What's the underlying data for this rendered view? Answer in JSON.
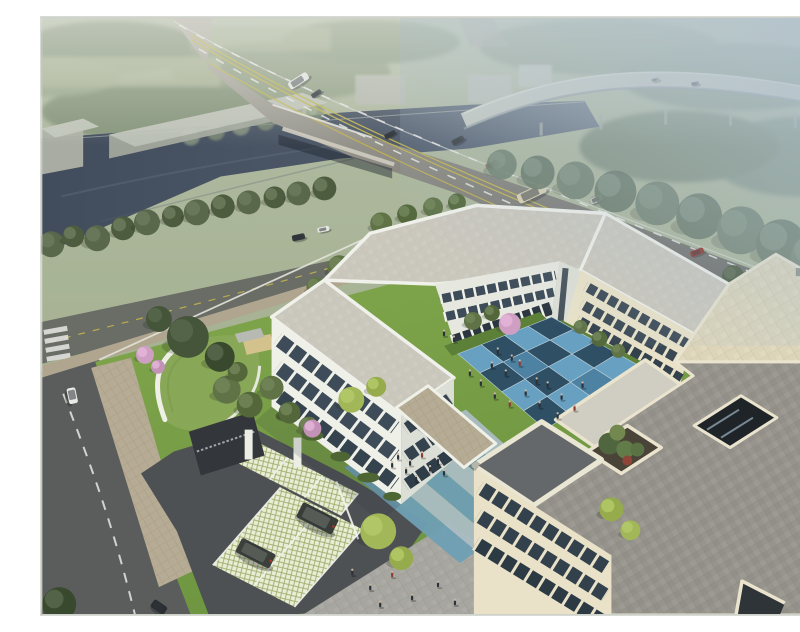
{
  "meta": {
    "alt": "Aerial architectural rendering of a three-story U-shaped cream campus building around a blue checkerboard courtyard, with entrance gate, green-roof gatehouse, grass-grid parking, landscaped gardens, an arterial road crossing a river bridge, and a hazy elevated highway ramp"
  },
  "palette": {
    "field": "#a4ae93",
    "field_light": "#aeb79a",
    "distant_tree": "#8c9a82",
    "water": "#485363",
    "water_light": "#647080",
    "warehouse_roof": "#c1c5bb",
    "warehouse_side": "#a3a89d",
    "ramp": "#c4c8c1",
    "road_far": "#b4b1a7",
    "road_near": "#5f5f5c",
    "lane_white": "#e8e8e4",
    "lane_yellow": "#c3b44e",
    "local_road": "#6a6c66",
    "access_road": "#5b5d5c",
    "sidewalk_tan": "#b6ab94",
    "lawn": "#79a147",
    "lawn_shade": "#5d8038",
    "hedge": "#4e6534",
    "bank_tree": "#59684a",
    "tree_dark": "#45553a",
    "tree_mid": "#5f7347",
    "tree_light": "#7d9254",
    "tree_yellow": "#a2b757",
    "tree_haze": "#5e7056",
    "blossom_pink": "#cf9fc3",
    "gatehouse_roof": "#88a757",
    "gatehouse_trim": "#edeee4",
    "driveway": "#4e5154",
    "lattice_bg": "#e9edd6",
    "lattice_line": "#9fae6e",
    "plaza": "#a7a6a0",
    "path_teal": "#6f9fb4",
    "path_light": "#aabcc3",
    "court_light": "#68a1c4",
    "court_dark": "#2e4e66",
    "court_mid": "#4e82a4",
    "wall_white": "#eff0e8",
    "wall_shade": "#dcdfd6",
    "wall_cream": "#e9e2c8",
    "glass": "#3c4b57",
    "glass_lit": "#9fb6c4",
    "roof_white": "#cac7bd",
    "roof_gray": "#96948c",
    "roof_beige": "#dcd5ba",
    "roof_dark": "#65686a",
    "parapet": "#f0f1ea",
    "parapet_cream": "#eae4cf",
    "planter_red": "#8e4538",
    "people_dark": "#2c3237",
    "people_red": "#8a3c33",
    "fog": "#acbfcd",
    "suv": "#383d3a"
  },
  "courtyard": {
    "corners": [
      [
        418,
        338
      ],
      [
        512,
        301
      ],
      [
        600,
        350
      ],
      [
        506,
        414
      ]
    ],
    "rows": 4,
    "cols": 4,
    "mid_tiles": [
      [
        1,
        1
      ],
      [
        2,
        3
      ]
    ]
  },
  "stripes": {
    "near": [
      [
        426,
        394
      ],
      [
        520,
        478
      ]
    ],
    "far": [
      [
        304,
        452
      ],
      [
        420,
        548
      ]
    ],
    "bands": 6
  },
  "vehicles": [
    {
      "name": "truck-distant",
      "x": 258,
      "y": 64,
      "rot": -33,
      "w": 22,
      "h": 8,
      "body": "#e3e5e1"
    },
    {
      "name": "car-distant",
      "x": 276,
      "y": 77,
      "rot": -33,
      "w": 11,
      "h": 5,
      "body": "#3c4247"
    },
    {
      "name": "car-bridge",
      "x": 350,
      "y": 118,
      "rot": -28,
      "w": 12,
      "h": 5,
      "body": "#30353a"
    },
    {
      "name": "sedan-dark",
      "x": 418,
      "y": 124,
      "rot": -27,
      "w": 13,
      "h": 6,
      "body": "#383d43"
    },
    {
      "name": "sedan-tan",
      "x": 452,
      "y": 148,
      "rot": -26,
      "w": 13,
      "h": 6,
      "body": "#8a7a5e"
    },
    {
      "name": "bus",
      "x": 492,
      "y": 177,
      "rot": -25,
      "w": 30,
      "h": 10,
      "body": "#d9d1b2"
    },
    {
      "name": "car-white",
      "x": 557,
      "y": 183,
      "rot": -23,
      "w": 13,
      "h": 6,
      "body": "#e8e8e3"
    },
    {
      "name": "car-red-1",
      "x": 658,
      "y": 236,
      "rot": -21,
      "w": 14,
      "h": 6,
      "body": "#8f2b22"
    },
    {
      "name": "car-red-2",
      "x": 751,
      "y": 283,
      "rot": -20,
      "w": 15,
      "h": 6,
      "body": "#9e2f26"
    },
    {
      "name": "car-local-dark",
      "x": 258,
      "y": 221,
      "rot": -12,
      "w": 13,
      "h": 6,
      "body": "#33383c"
    },
    {
      "name": "car-local-white",
      "x": 283,
      "y": 213,
      "rot": -12,
      "w": 12,
      "h": 5,
      "body": "#e6e7e2"
    },
    {
      "name": "van-access",
      "x": 31,
      "y": 380,
      "rot": 78,
      "w": 16,
      "h": 9,
      "body": "#e9eae5"
    },
    {
      "name": "car-access",
      "x": 118,
      "y": 592,
      "rot": 35,
      "w": 16,
      "h": 9,
      "body": "#2b2f33"
    },
    {
      "name": "suv-1",
      "x": 277,
      "y": 503,
      "rot": 27,
      "w": 40,
      "h": 17,
      "body": "#383d3a"
    },
    {
      "name": "suv-2",
      "x": 215,
      "y": 538,
      "rot": 27,
      "w": 38,
      "h": 16,
      "body": "#3b403c"
    },
    {
      "name": "car-ramp-1",
      "x": 616,
      "y": 63,
      "rot": -12,
      "w": 8,
      "h": 4,
      "body": "#9aa1a4"
    },
    {
      "name": "car-ramp-2",
      "x": 656,
      "y": 67,
      "rot": -8,
      "w": 8,
      "h": 4,
      "body": "#70777c"
    }
  ],
  "trees": {
    "bank": [
      [
        10,
        228,
        13
      ],
      [
        32,
        220,
        11
      ],
      [
        56,
        222,
        13
      ],
      [
        82,
        212,
        12
      ],
      [
        106,
        206,
        13
      ],
      [
        132,
        200,
        11
      ],
      [
        156,
        196,
        13
      ],
      [
        182,
        190,
        12
      ],
      [
        208,
        186,
        12
      ],
      [
        234,
        181,
        11
      ],
      [
        258,
        177,
        12
      ],
      [
        284,
        172,
        12
      ]
    ],
    "haze_band": [
      [
        462,
        148,
        15
      ],
      [
        498,
        156,
        17
      ],
      [
        536,
        164,
        19
      ],
      [
        576,
        175,
        21
      ],
      [
        618,
        187,
        22
      ],
      [
        660,
        200,
        23
      ],
      [
        702,
        214,
        24
      ],
      [
        742,
        228,
        25
      ],
      [
        776,
        241,
        24
      ]
    ],
    "street_right": [
      [
        694,
        260,
        11
      ],
      [
        727,
        279,
        12
      ],
      [
        761,
        299,
        12
      ]
    ],
    "verge": [
      [
        341,
        207,
        11
      ],
      [
        367,
        198,
        10
      ],
      [
        393,
        191,
        10
      ],
      [
        417,
        186,
        9
      ]
    ],
    "lawn_nw": [
      [
        299,
        251,
        12
      ],
      [
        321,
        238,
        10
      ],
      [
        276,
        271,
        10
      ]
    ],
    "garden": [
      [
        186,
        374,
        14
      ],
      [
        209,
        389,
        13
      ],
      [
        231,
        372,
        12
      ],
      [
        249,
        397,
        11
      ],
      [
        268,
        411,
        10
      ],
      [
        197,
        356,
        10
      ]
    ],
    "big_dark": [
      [
        147,
        321,
        21
      ],
      [
        179,
        341,
        15
      ],
      [
        118,
        303,
        13
      ],
      [
        18,
        589,
        17
      ]
    ],
    "court_n": [
      [
        433,
        305,
        9
      ],
      [
        452,
        297,
        8
      ]
    ],
    "ne_base": [
      [
        541,
        311,
        7
      ],
      [
        560,
        323,
        8
      ],
      [
        579,
        335,
        7
      ]
    ],
    "yellow": [
      [
        311,
        384,
        13
      ],
      [
        336,
        371,
        10
      ],
      [
        338,
        516,
        18
      ],
      [
        361,
        543,
        12
      ],
      [
        781,
        570,
        13
      ],
      [
        572,
        494,
        12
      ],
      [
        591,
        515,
        10
      ]
    ],
    "blossom": [
      [
        470,
        308,
        11
      ],
      [
        272,
        413,
        9
      ],
      [
        104,
        339,
        9
      ],
      [
        117,
        351,
        7
      ]
    ],
    "riverbank_n": [
      [
        150,
        120,
        9
      ],
      [
        175,
        115,
        9
      ],
      [
        200,
        110,
        9
      ],
      [
        225,
        105,
        9
      ],
      [
        250,
        100,
        9
      ],
      [
        275,
        96,
        9
      ]
    ]
  },
  "people": {
    "courtyard": [
      [
        452,
        352,
        "d"
      ],
      [
        466,
        360,
        "d"
      ],
      [
        480,
        350,
        "r"
      ],
      [
        497,
        368,
        "d"
      ],
      [
        455,
        383,
        "d"
      ],
      [
        470,
        391,
        "r"
      ],
      [
        486,
        380,
        "d"
      ],
      [
        508,
        372,
        "d"
      ],
      [
        522,
        384,
        "d"
      ],
      [
        535,
        395,
        "r"
      ],
      [
        543,
        372,
        "d"
      ],
      [
        458,
        338,
        "d"
      ],
      [
        472,
        345,
        "d"
      ],
      [
        430,
        360,
        "d"
      ],
      [
        441,
        370,
        "d"
      ],
      [
        518,
        403,
        "d"
      ],
      [
        500,
        392,
        "d"
      ]
    ],
    "plaza": [
      [
        312,
        560,
        "d"
      ],
      [
        330,
        575,
        "d"
      ],
      [
        352,
        562,
        "r"
      ],
      [
        372,
        585,
        "d"
      ],
      [
        398,
        572,
        "d"
      ],
      [
        340,
        592,
        "d"
      ],
      [
        415,
        590,
        "d"
      ]
    ],
    "path": [
      [
        358,
        444,
        "d"
      ],
      [
        370,
        450,
        "d"
      ],
      [
        382,
        442,
        "r"
      ],
      [
        366,
        458,
        "d"
      ],
      [
        390,
        456,
        "d"
      ],
      [
        352,
        452,
        "d"
      ],
      [
        398,
        448,
        "d"
      ],
      [
        404,
        460,
        "d"
      ],
      [
        376,
        466,
        "d"
      ]
    ],
    "lawn_n": [
      [
        404,
        320,
        "d"
      ],
      [
        414,
        326,
        "d"
      ]
    ]
  }
}
